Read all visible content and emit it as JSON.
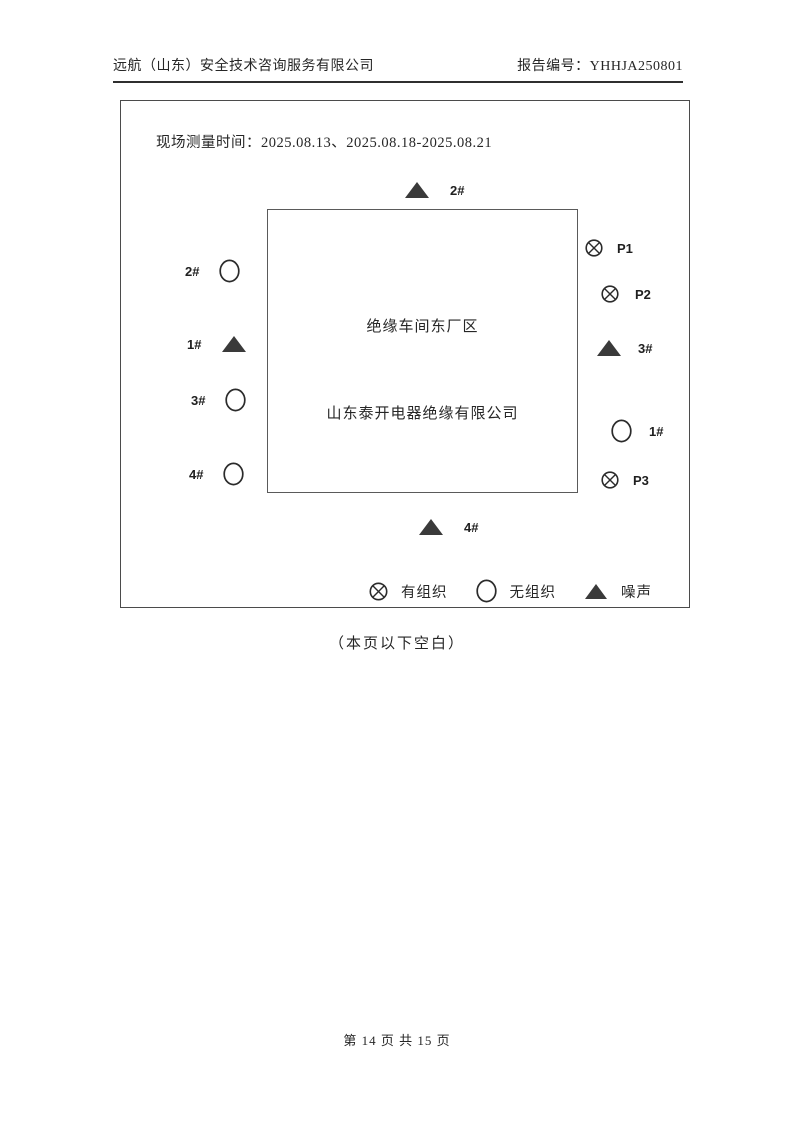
{
  "page": {
    "header": {
      "company": "远航（山东）安全技术咨询服务有限公司",
      "report_no": "报告编号：YHHJA250801"
    },
    "diagram": {
      "measure_time": "现场测量时间：2025.08.13、2025.08.18-2025.08.21",
      "site": {
        "area_label": "绝缘车间东厂区",
        "company_label": "山东泰开电器绝缘有限公司"
      },
      "markers": {
        "top": {
          "type": "noise",
          "label": "2#"
        },
        "left": [
          {
            "type": "unorganized",
            "label": "2#"
          },
          {
            "type": "noise",
            "label": "1#"
          },
          {
            "type": "unorganized",
            "label": "3#"
          },
          {
            "type": "unorganized",
            "label": "4#"
          }
        ],
        "right": [
          {
            "type": "organized",
            "label": "P1"
          },
          {
            "type": "organized",
            "label": "P2"
          },
          {
            "type": "noise",
            "label": "3#"
          },
          {
            "type": "unorganized",
            "label": "1#"
          },
          {
            "type": "organized",
            "label": "P3"
          }
        ],
        "bottom": {
          "type": "noise",
          "label": "4#"
        }
      },
      "legend": {
        "organized": "有组织",
        "unorganized": "无组织",
        "noise": "噪声"
      }
    },
    "note": "（本页以下空白）",
    "footer": "第 14 页 共 15 页"
  },
  "colors": {
    "ink": "#262626",
    "frame_border": "#4b4b4b",
    "triangle_fill": "#3a3a3a",
    "symbol_stroke": "#2b2b2b"
  }
}
